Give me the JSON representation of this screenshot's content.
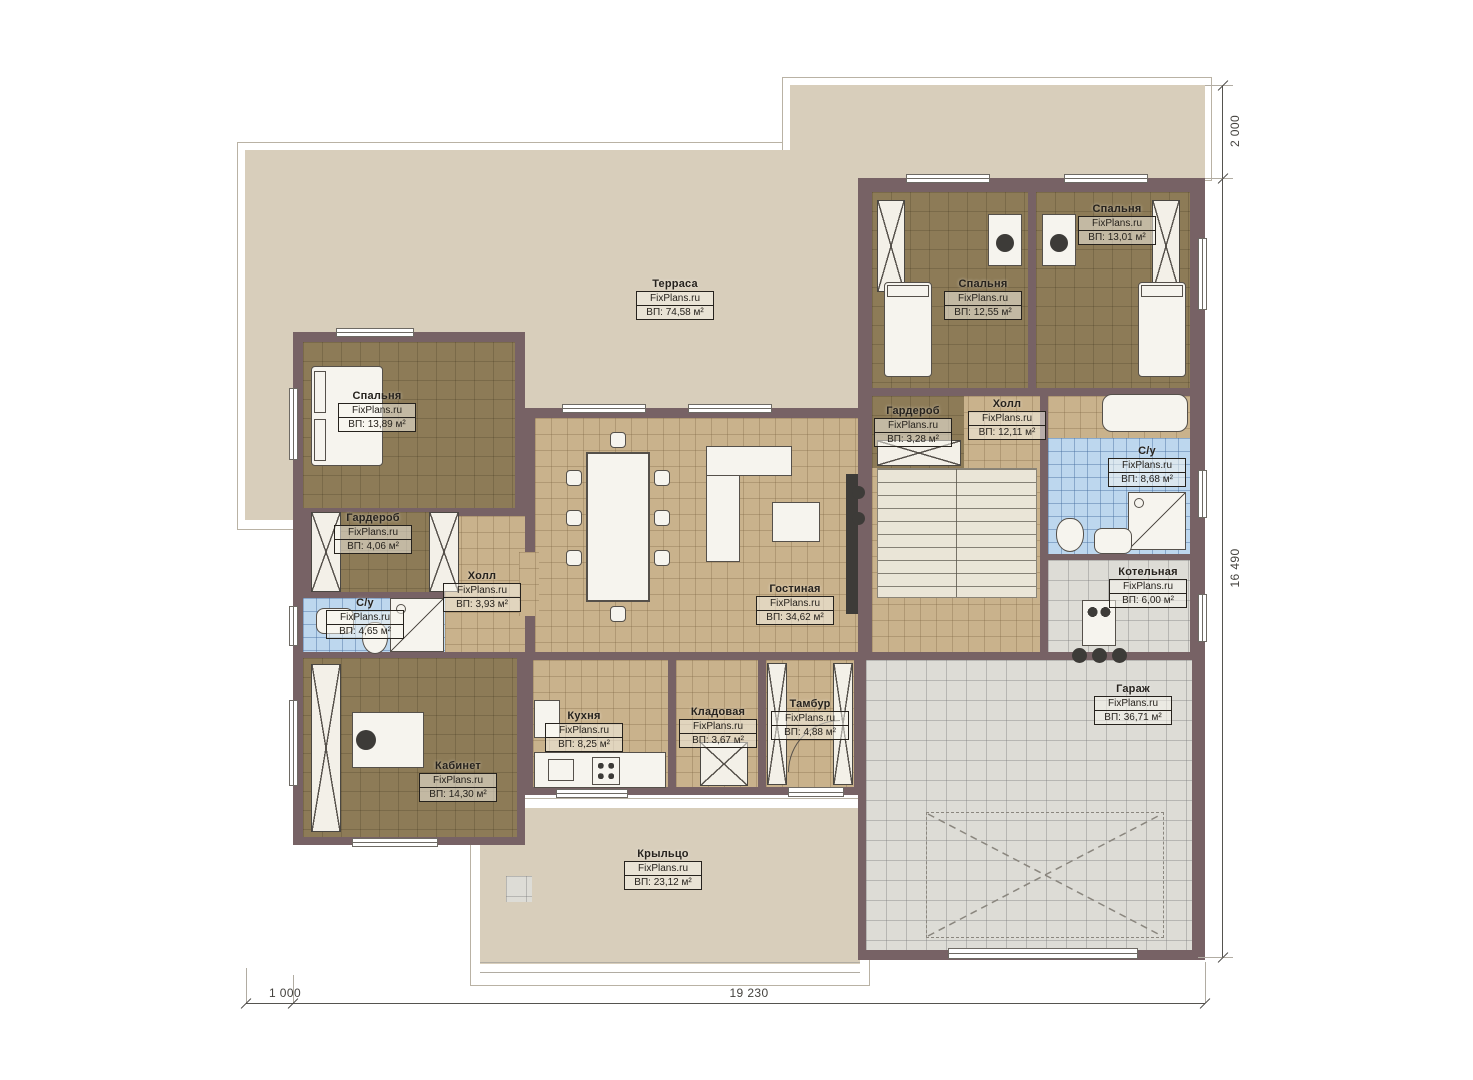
{
  "plan": {
    "brand": "FixPlans.ru",
    "rooms": [
      {
        "name": "Терраса",
        "area": "ВП: 74,58 м²"
      },
      {
        "name": "Спальня",
        "area": "ВП: 13,89 м²"
      },
      {
        "name": "Гардероб",
        "area": "ВП: 4,06 м²"
      },
      {
        "name": "С/у",
        "area": "ВП: 4,65 м²"
      },
      {
        "name": "Холл",
        "area": "ВП: 3,93 м²"
      },
      {
        "name": "Кабинет",
        "area": "ВП: 14,30 м²"
      },
      {
        "name": "Кухня",
        "area": "ВП: 8,25 м²"
      },
      {
        "name": "Кладовая",
        "area": "ВП: 3,67 м²"
      },
      {
        "name": "Тамбур",
        "area": "ВП: 4,88 м²"
      },
      {
        "name": "Гостиная",
        "area": "ВП: 34,62 м²"
      },
      {
        "name": "Крыльцо",
        "area": "ВП: 23,12 м²"
      },
      {
        "name": "Спальня",
        "area": "ВП: 12,55 м²"
      },
      {
        "name": "Спальня",
        "area": "ВП: 13,01 м²"
      },
      {
        "name": "Гардероб",
        "area": "ВП: 3,28 м²"
      },
      {
        "name": "Холл",
        "area": "ВП: 12,11 м²"
      },
      {
        "name": "С/у",
        "area": "ВП: 8,68 м²"
      },
      {
        "name": "Котельная",
        "area": "ВП: 6,00 м²"
      },
      {
        "name": "Гараж",
        "area": "ВП: 36,71 м²"
      }
    ],
    "dimensions": {
      "top_right": "2 000",
      "right_side": "16 490",
      "bottom_left": "1 000",
      "bottom": "19 230"
    },
    "colors": {
      "wall": "#776265",
      "paving": "#d8cebb",
      "floor_wood": "#c9b28c",
      "floor_dark": "#8d7b57",
      "tile_bath": "#bdd7ee",
      "tile_garage": "#dddcd6"
    }
  }
}
